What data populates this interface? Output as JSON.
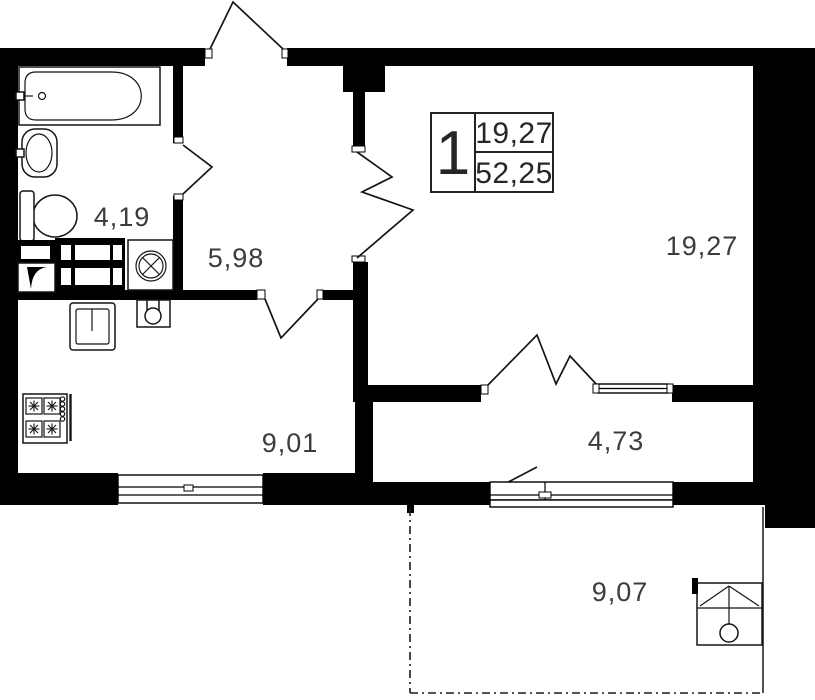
{
  "plan": {
    "title": "1-room apartment floor plan",
    "unit_box": {
      "rooms_count": "1",
      "living_area": "19,27",
      "total_area": "52,25"
    },
    "rooms": [
      {
        "id": "bathroom",
        "area": "4,19"
      },
      {
        "id": "hallway",
        "area": "5,98"
      },
      {
        "id": "living-room",
        "area": "19,27"
      },
      {
        "id": "kitchen",
        "area": "9,01"
      },
      {
        "id": "corridor",
        "area": "4,73"
      },
      {
        "id": "balcony",
        "area": "9,07"
      }
    ],
    "fixtures": [
      "bathtub-icon",
      "wash-basin-icon",
      "toilet-icon",
      "washing-machine-icon",
      "bathroom-cabinet-icon",
      "vent-duct-icon",
      "kitchen-sink-icon",
      "water-heater-icon",
      "stove-icon",
      "ac-unit-icon"
    ],
    "colors": {
      "wall": "#000000",
      "line": "#1a1a1a",
      "label": "#3c3c3c",
      "unit_text": "#262626",
      "bg": "#ffffff"
    }
  }
}
